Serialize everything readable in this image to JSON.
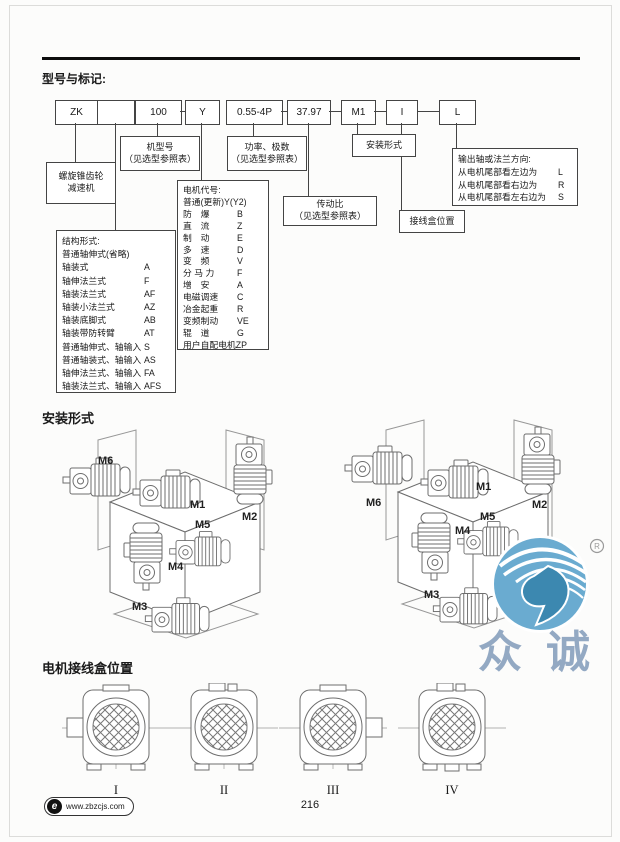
{
  "s1": {
    "title": "型号与标记:",
    "code_boxes": [
      "ZK",
      "",
      "100",
      "Y",
      "0.55-4P",
      "37.97",
      "M1",
      "I",
      "L"
    ],
    "reducer": [
      "螺旋锥齿轮",
      "减速机"
    ],
    "model": [
      "机型号",
      "（见选型参照表）"
    ],
    "power": [
      "功率、极数",
      "（见选型参照表）"
    ],
    "ratio": [
      "传动比",
      "（见选型参照表）"
    ],
    "mounting": "安装形式",
    "terminal": "接线盒位置",
    "output": {
      "title": "输出轴或法兰方向:",
      "rows": [
        [
          "从电机尾部看左边为",
          "L"
        ],
        [
          "从电机尾部看右边为",
          "R"
        ],
        [
          "从电机尾部看左右边为",
          "S"
        ]
      ]
    },
    "structure": {
      "title": "结构形式:",
      "subtitle": "普通轴伸式(省略)",
      "rows": [
        [
          "轴装式",
          "A"
        ],
        [
          "轴伸法兰式",
          "F"
        ],
        [
          "轴装法兰式",
          "AF"
        ],
        [
          "轴装小法兰式",
          "AZ"
        ],
        [
          "轴装底脚式",
          "AB"
        ],
        [
          "轴装带防转臂",
          "AT"
        ],
        [
          "普通轴伸式、轴输入",
          "S"
        ],
        [
          "普通轴装式、轴输入",
          "AS"
        ],
        [
          "轴伸法兰式、轴输入",
          "FA"
        ],
        [
          "轴装法兰式、轴输入",
          "AFS"
        ]
      ]
    },
    "motor": {
      "title": "电机代号:",
      "subtitle": "普通(更新)Y(Y2)",
      "rows": [
        [
          "防　爆",
          "B"
        ],
        [
          "直　流",
          "Z"
        ],
        [
          "制　动",
          "E"
        ],
        [
          "多　速",
          "D"
        ],
        [
          "变　频",
          "V"
        ],
        [
          "分 马 力",
          "F"
        ],
        [
          "增　安",
          "A"
        ],
        [
          "电磁调速",
          "C"
        ],
        [
          "冶金起重",
          "R"
        ],
        [
          "变频制动",
          "VE"
        ],
        [
          "辊　道",
          "G"
        ]
      ],
      "footer": "用户自配电机ZP"
    }
  },
  "install": {
    "title": "安装形式",
    "m": {
      "m1": "M1",
      "m2": "M2",
      "m3": "M3",
      "m4": "M4",
      "m5": "M5",
      "m6": "M6"
    }
  },
  "tb": {
    "title": "电机接线盒位置",
    "items": [
      "I",
      "II",
      "III",
      "IV"
    ]
  },
  "wm": {
    "c1": "众",
    "c2": "诚",
    "reg": "R",
    "blue": "#6aabd0",
    "text_blue": "#8ba2bf"
  },
  "footer": {
    "logo": "e",
    "site": "www.zbzcjs.com",
    "page": "216"
  }
}
